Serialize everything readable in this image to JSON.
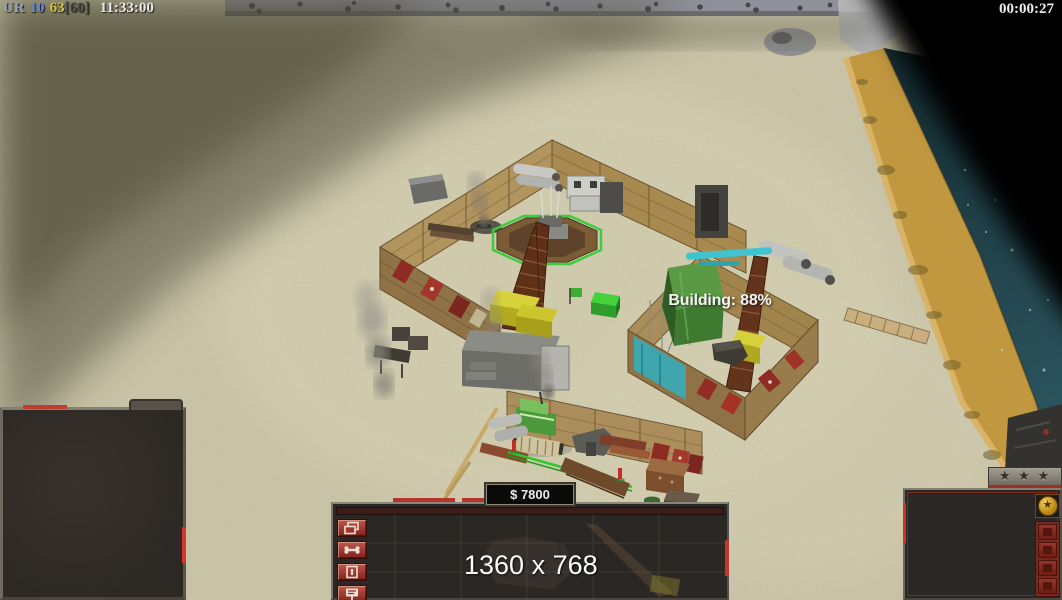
{
  "hud": {
    "status_bar": {
      "segments": [
        {
          "text": "UR",
          "color": "#98a0b4"
        },
        {
          "text": "10",
          "color": "#6288d8"
        },
        {
          "text": "63",
          "color": "#d2c23c"
        },
        {
          "text": "[60]",
          "color": "#4a4a44"
        },
        {
          "text": "11:33:00",
          "color": "#e9e9ec"
        }
      ]
    },
    "game_timer": "00:00:27",
    "building_progress": "Building: 88%",
    "money": "$ 7800",
    "resolution_overlay": "1360 x 768"
  },
  "command_bar": {
    "side_buttons": [
      {
        "icon": "stacked-windows-icon"
      },
      {
        "icon": "bone-icon"
      },
      {
        "icon": "pause-box-icon"
      },
      {
        "icon": "signpost-icon"
      }
    ]
  },
  "rank_panel": {
    "tab_stars": "★ ★ ★",
    "emblem_glyph": "★",
    "emblem_icon": "gold-star-medal-icon",
    "small_buttons": [
      {
        "icon": "ability-slot-icon"
      },
      {
        "icon": "ability-slot-icon"
      },
      {
        "icon": "ability-slot-icon"
      },
      {
        "icon": "ability-slot-icon"
      }
    ]
  },
  "theme": {
    "sand": "#cbc5a9",
    "shadow_olive": "#4f4e3c",
    "beach_gold": "#c1973f",
    "water_dark": "#142c32",
    "wall_tan": "#b2945f",
    "selection_green": "#3ecb3e",
    "button_red": "#8e2a22",
    "panel_dark": "#2b2724",
    "frame_gray": "#7b776d"
  }
}
